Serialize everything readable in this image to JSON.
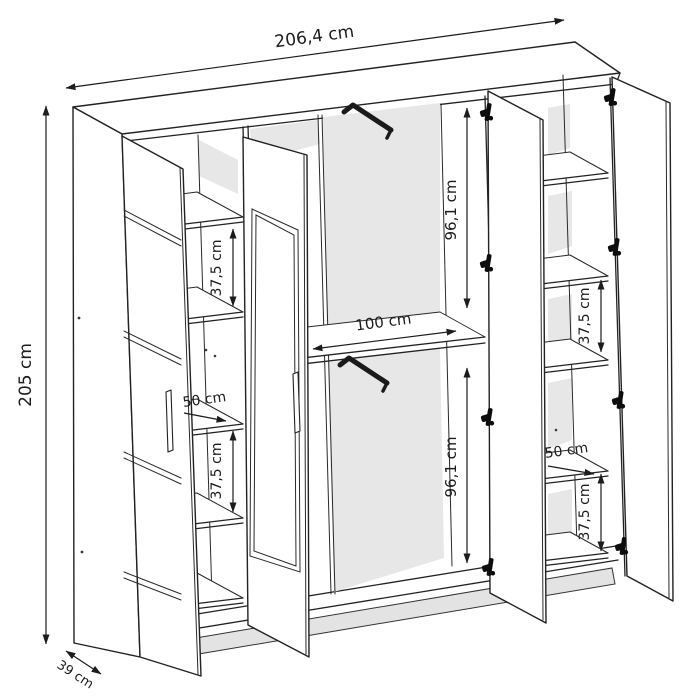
{
  "diagram": {
    "type": "furniture-technical-drawing",
    "subject": "4-door wardrobe with open doors, shelves and hanging rails"
  },
  "annotations": {
    "overall_width": "206,4 cm",
    "overall_height": "205 cm",
    "depth": "39 cm",
    "hanging_space_upper": "96,1 cm",
    "hanging_space_lower": "96,1 cm",
    "center_shelf_width": "100 cm",
    "left_column_shelf_width": "50 cm",
    "right_column_shelf_width": "50 cm",
    "left_column_spacing_upper": "37,5 cm",
    "left_column_spacing_lower": "37,5 cm",
    "right_column_spacing_upper": "37,5 cm",
    "right_column_spacing_lower": "37,5 cm"
  },
  "icons": {
    "hinge": "hinge-icon",
    "hanging_rail": "hanging-rail-icon",
    "dimension_arrow": "double-arrow-icon"
  },
  "colors": {
    "background": "#ffffff",
    "ink": "#222222",
    "interior_shade": "#e7e7e7",
    "plinth_shade": "#e3e3e3",
    "text": "#1c1c1c"
  }
}
